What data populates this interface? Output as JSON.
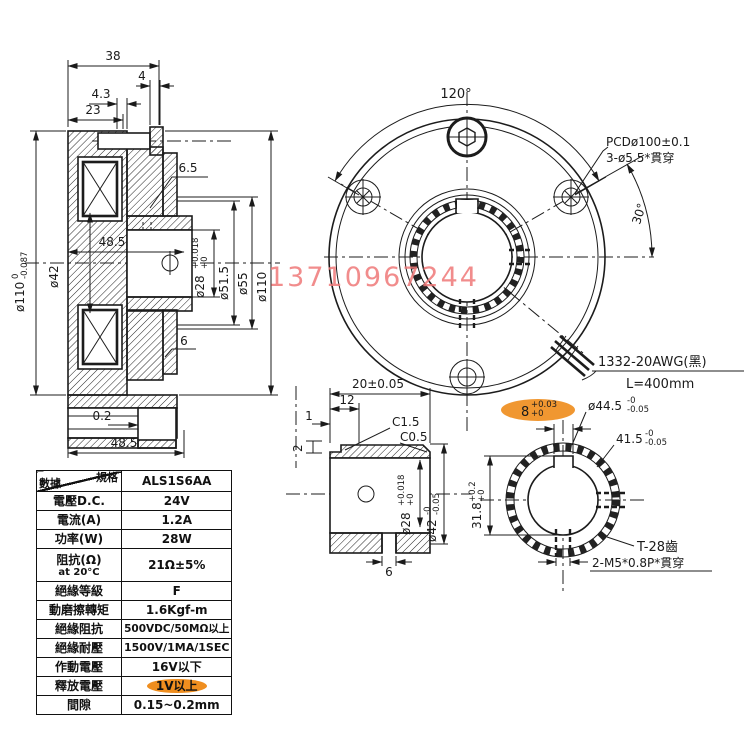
{
  "drawing": {
    "watermark": "13710967244",
    "side_view": {
      "dim_38": "38",
      "dim_4": "4",
      "dim_4_3": "4.3",
      "dim_23": "23",
      "dim_6_5": "6.5",
      "dim_48_5_mid": "48.5",
      "dim_0_2": "0.2",
      "dim_48_5_bot": "48.5",
      "dim_6": "6",
      "dia110_left": {
        "main": "ø110",
        "tol_top": "0",
        "tol_bot": "-0.087"
      },
      "dia42": "ø42",
      "dia28": {
        "main": "ø28",
        "tol_top": "+0.018",
        "tol_bot": "+0"
      },
      "dia51_5": "ø51.5",
      "dia55": "ø55",
      "dia110_right": "ø110"
    },
    "front_view": {
      "angle_span": "120°",
      "angle_offset": "30°",
      "pcd_note_1": "PCDø100±0.1",
      "pcd_note_2": "3-ø5.5*貫穿",
      "wire_note_1": "1332-20AWG(黑)",
      "wire_note_2": "L=400mm"
    },
    "hub_view": {
      "dim_20": "20±0.05",
      "dim_12": "12",
      "dim_1": "1",
      "dim_2": "2",
      "chamfer_1": "C1.5",
      "chamfer_2": "C0.5",
      "dia28": {
        "main": "ø28",
        "tol_top": "+0.018",
        "tol_bot": "+0"
      },
      "dia42": {
        "main": "ø42",
        "tol_top": "-0",
        "tol_bot": "-0.05"
      },
      "dim_6": "6"
    },
    "gear_view": {
      "dim_8": {
        "main": "8",
        "tol_top": "+0.03",
        "tol_bot": "+0"
      },
      "dia44_5": {
        "main": "ø44.5",
        "tol_top": "-0",
        "tol_bot": "-0.05"
      },
      "dim_41_5": {
        "main": "41.5",
        "tol_top": "-0",
        "tol_bot": "-0.05"
      },
      "dim_31_8": {
        "main": "31.8",
        "tol_top": "+0.2",
        "tol_bot": "+0"
      },
      "teeth_note": "T-28齒",
      "tap_note": "2-M5*0.8P*貫穿"
    }
  },
  "spec_table": {
    "header": {
      "corner_top": "規格",
      "corner_bottom": "數據",
      "model": "ALS1S6AA"
    },
    "rows": [
      {
        "label": "電壓D.C.",
        "value": "24V"
      },
      {
        "label": "電流(A)",
        "value": "1.2A"
      },
      {
        "label": "功率(W)",
        "value": "28W"
      },
      {
        "label": "阻抗(Ω)",
        "label2": "at 20°C",
        "value": "21Ω±5%"
      },
      {
        "label": "絕緣等級",
        "value": "F"
      },
      {
        "label": "動磨擦轉矩",
        "value": "1.6Kgf-m"
      },
      {
        "label": "絕緣阻抗",
        "value": "500VDC/50MΩ以上"
      },
      {
        "label": "絕緣耐壓",
        "value": "1500V/1MA/1SEC"
      },
      {
        "label": "作動電壓",
        "value": "16V以下"
      },
      {
        "label": "釋放電壓",
        "value": "1V以上"
      },
      {
        "label": "間隙",
        "value": "0.15~0.2mm"
      }
    ]
  }
}
